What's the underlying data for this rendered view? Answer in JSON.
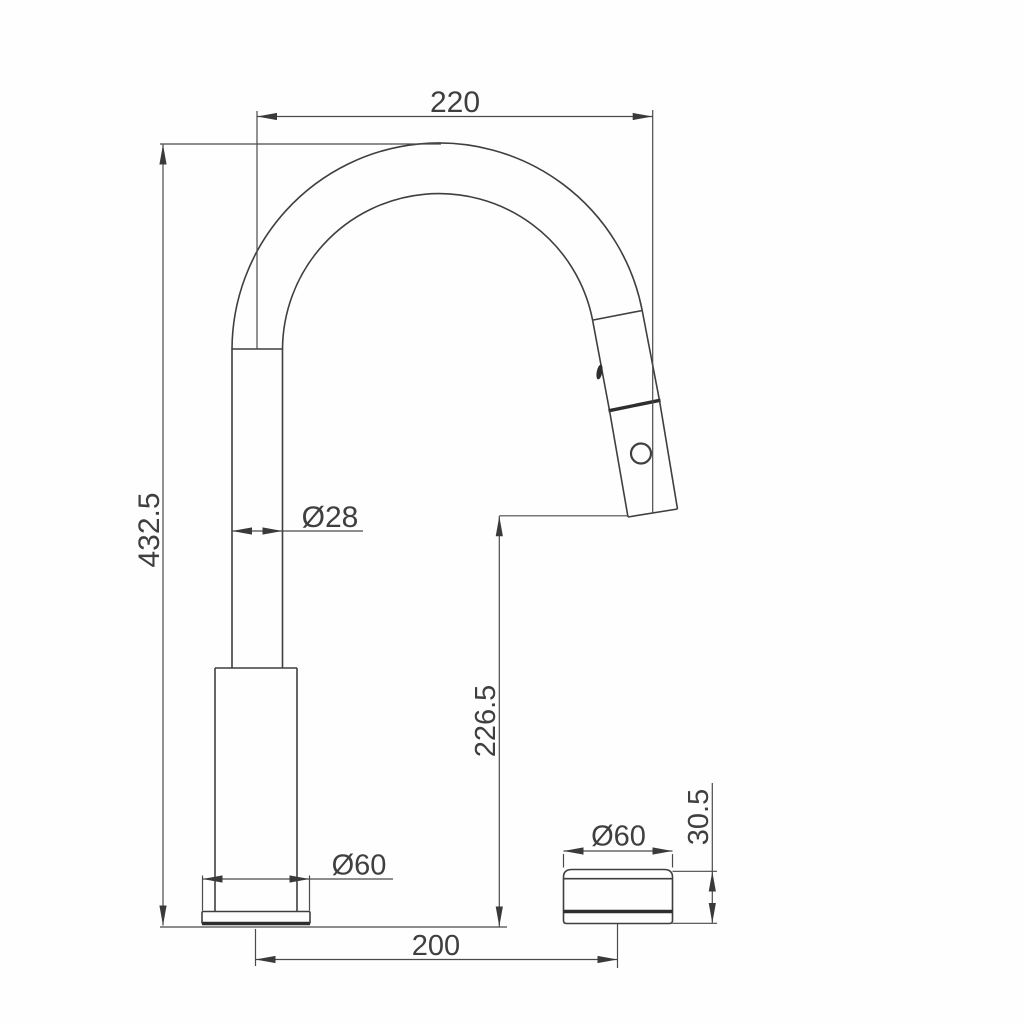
{
  "drawing": {
    "kind": "faucet-dimension-diagram",
    "dims": {
      "spout_reach": "220",
      "overall_height": "432.5",
      "spout_tube_diameter": "Ø28",
      "outlet_height": "226.5",
      "base_diameter": "Ø60",
      "remote_diameter": "Ø60",
      "remote_height": "30.5",
      "center_spacing": "200"
    },
    "colors": {
      "line": "#3f3f3f",
      "thick_line": "#2e2e2e",
      "dimension_line": "#4a4a4a",
      "text": "#3f3f3f",
      "background": "#fefefe"
    }
  }
}
